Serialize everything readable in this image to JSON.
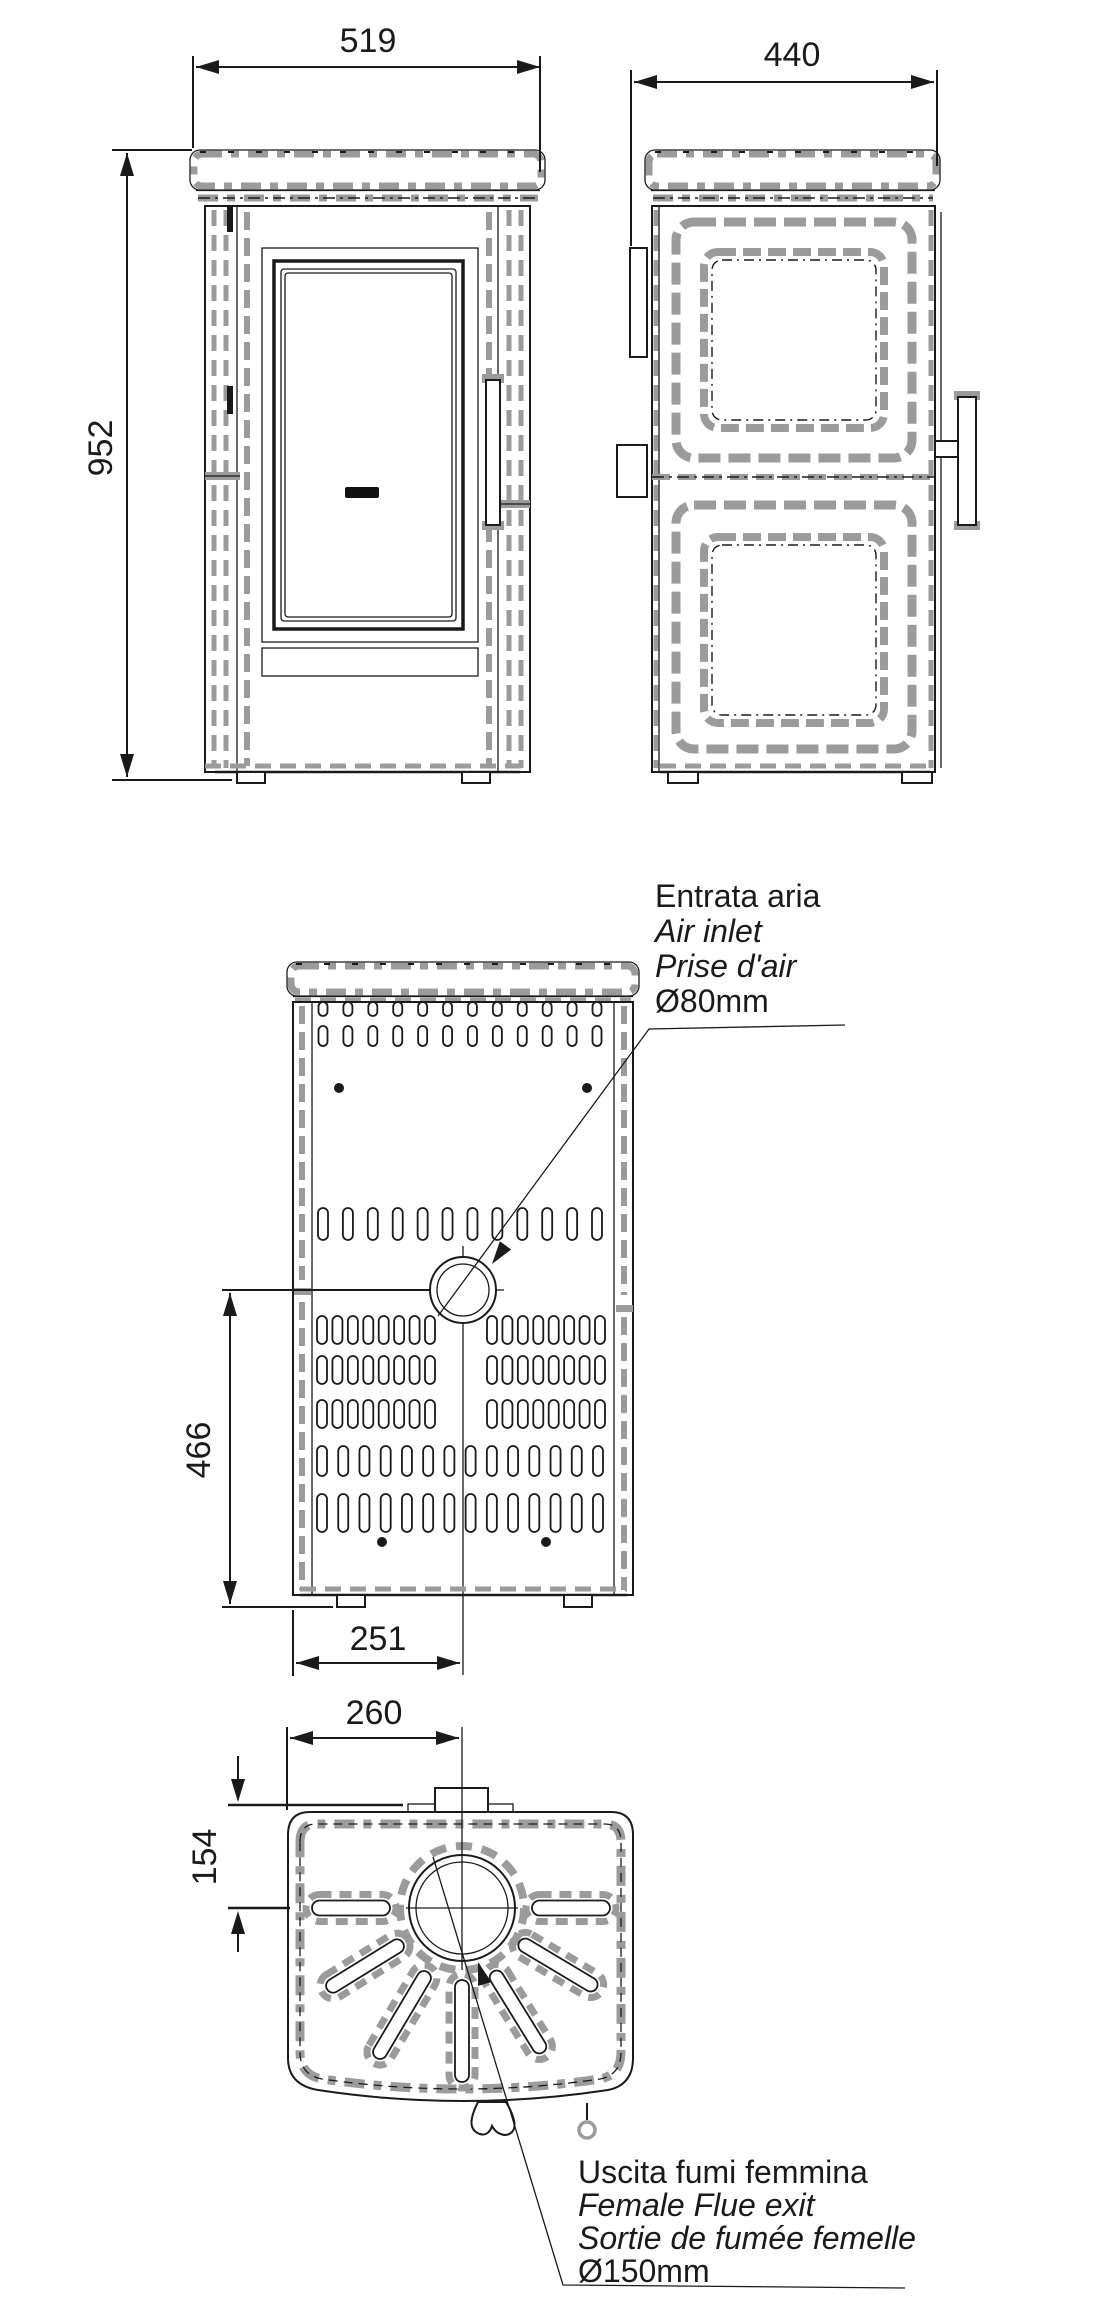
{
  "title": "stove-technical-drawing",
  "palette": {
    "line": "#1a1a1a",
    "seam": "#9b9b9b",
    "background": "#ffffff"
  },
  "dimensions": {
    "front_width": "519",
    "front_height": "952",
    "side_depth": "440",
    "air_inlet_height": "466",
    "air_inlet_offset": "251",
    "flue_offset_x": "260",
    "flue_offset_y": "154"
  },
  "annotations": {
    "air_inlet": {
      "it": "Entrata aria",
      "en": "Air inlet",
      "fr": "Prise d'air",
      "diameter": "Ø80mm"
    },
    "flue_exit": {
      "it": "Uscita fumi femmina",
      "en": "Female Flue exit",
      "fr": "Sortie de fumée femelle",
      "diameter": "Ø150mm"
    }
  }
}
